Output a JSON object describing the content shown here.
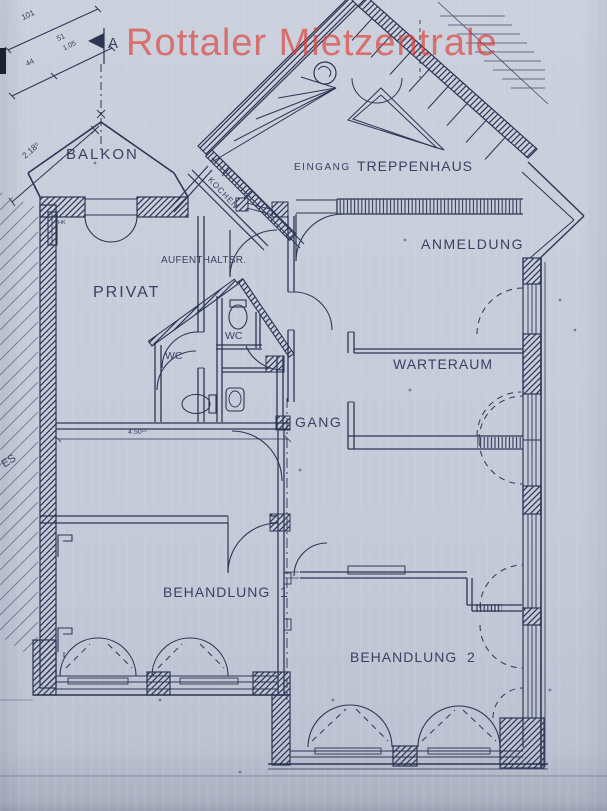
{
  "watermark": {
    "text": "Rottaler Mietzentrale",
    "color": "#dd3c37"
  },
  "section_marker": {
    "label": "A"
  },
  "rooms": {
    "balkon": "BALKON",
    "eingang": "EINGANG",
    "treppenhaus": "TREPPENHAUS",
    "anmeldung": "ANMELDUNG",
    "kochen": "KOCHEN",
    "aufenthaltsraum": "AUFENTHALTSR.",
    "privat": "PRIVAT",
    "wc_upper": "WC",
    "wc_lower": "WC",
    "warteraum": "WARTERAUM",
    "gang": "GANG",
    "behandlung_1": "BEHANDLUNG  1",
    "behandlung_2": "BEHANDLUNG  2"
  },
  "annotations": {
    "radiator": "HK",
    "edge_fragment": "ES"
  },
  "dimensions": {
    "d101": "101",
    "d51": "51",
    "d105": "1.05",
    "d44": "44",
    "d2185": "2.18⁵",
    "d450": "4.50¹⁵"
  },
  "colors": {
    "paper": "#c6ccd9",
    "ink": "#2d3554",
    "watermark_red": "#dd3c37"
  }
}
